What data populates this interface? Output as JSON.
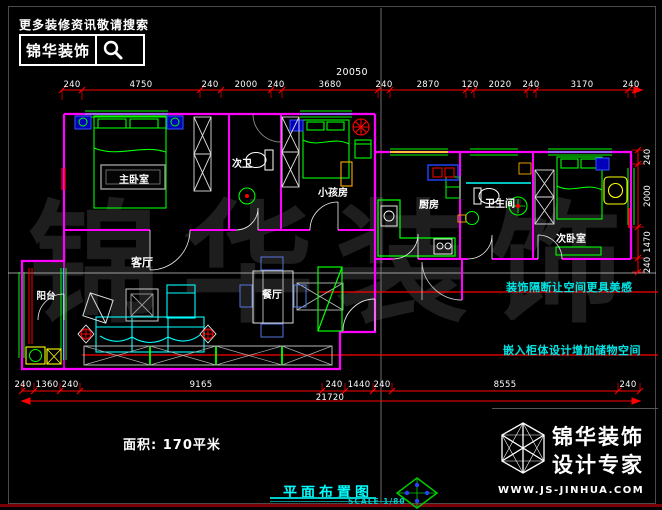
{
  "header": {
    "tagline": "更多装修资讯敬请搜索",
    "brand": "锦华装饰",
    "search_icon": "magnifier-icon"
  },
  "watermark": {
    "text": "锦华装饰"
  },
  "rooms": [
    {
      "name": "主卧室"
    },
    {
      "name": "次卫"
    },
    {
      "name": "小孩房"
    },
    {
      "name": "厨房"
    },
    {
      "name": "卫生间"
    },
    {
      "name": "次卧室"
    },
    {
      "name": "客厅"
    },
    {
      "name": "餐厅"
    },
    {
      "name": "阳台"
    }
  ],
  "annotations": [
    {
      "text": "装饰隔断让空间更具美感"
    },
    {
      "text": "嵌入柜体设计增加储物空间"
    }
  ],
  "dimensions": {
    "top": {
      "total": "20050",
      "segments": [
        "240",
        "4750",
        "240",
        "2000",
        "240",
        "3680",
        "240",
        "2870",
        "120",
        "2020",
        "240",
        "3170",
        "240"
      ]
    },
    "bottom": {
      "total": "21720",
      "segments": [
        "240",
        "1360",
        "240",
        "9165",
        "240",
        "1440",
        "240",
        "8555",
        "240"
      ]
    },
    "right": {
      "segments": [
        "240",
        "2000",
        "1470",
        "240"
      ]
    }
  },
  "footer": {
    "area_label": "面积: 170平米",
    "drawing_title": "平面布置图",
    "scale": "SCALE 1/80"
  },
  "branding": {
    "name": "锦华装饰",
    "subtitle": "设计专家",
    "website": "WWW.JS-JINHUA.COM"
  },
  "colors": {
    "wall": "#ff00ff",
    "furniture": "#00ff00",
    "dimension_line": "#ff0000",
    "dimension_text": "#ffffff",
    "annotation": "#00e5e5",
    "title": "#00ffff",
    "background": "#000000"
  }
}
